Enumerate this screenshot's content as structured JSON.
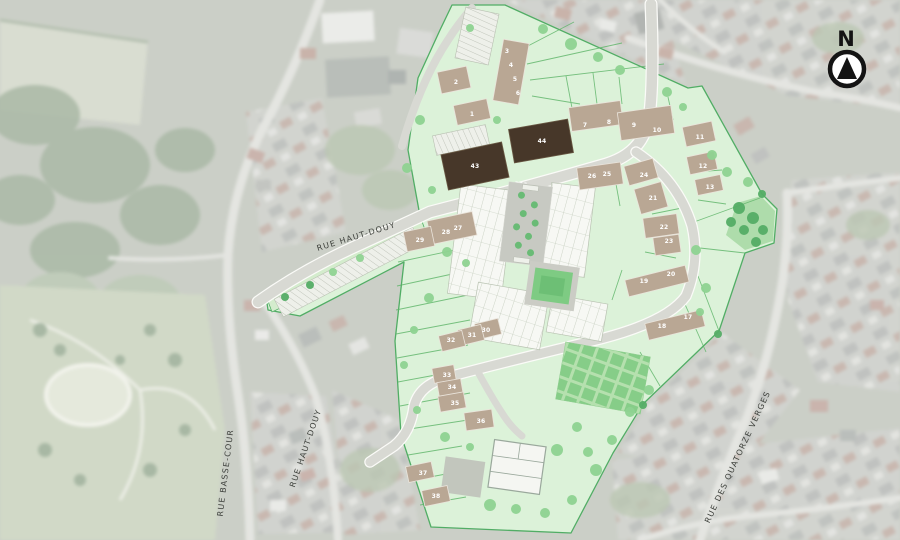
{
  "compass": {
    "label": "N"
  },
  "streets": [
    {
      "id": "rue-haut-douy-upper",
      "label": "RUE HAUT-DOUY",
      "x": 357,
      "y": 239,
      "angle": -17
    },
    {
      "id": "rue-basse-cour",
      "label": "RUE BASSE-COUR",
      "x": 228,
      "y": 473,
      "angle": -83
    },
    {
      "id": "rue-haut-douy-lower",
      "label": "RUE HAUT-DOUY",
      "x": 308,
      "y": 449,
      "angle": -71
    },
    {
      "id": "rue-des-quatorze-verges",
      "label": "RUE DES QUATORZE VERGES",
      "x": 740,
      "y": 458,
      "angle": -65
    }
  ],
  "lots": [
    {
      "n": "1",
      "x": 472,
      "y": 116
    },
    {
      "n": "2",
      "x": 456,
      "y": 84
    },
    {
      "n": "3",
      "x": 507,
      "y": 53
    },
    {
      "n": "4",
      "x": 511,
      "y": 67
    },
    {
      "n": "5",
      "x": 515,
      "y": 81
    },
    {
      "n": "6",
      "x": 518,
      "y": 95
    },
    {
      "n": "7",
      "x": 585,
      "y": 127
    },
    {
      "n": "8",
      "x": 609,
      "y": 124
    },
    {
      "n": "9",
      "x": 634,
      "y": 127
    },
    {
      "n": "10",
      "x": 657,
      "y": 132
    },
    {
      "n": "11",
      "x": 700,
      "y": 139
    },
    {
      "n": "12",
      "x": 703,
      "y": 168
    },
    {
      "n": "13",
      "x": 710,
      "y": 189
    },
    {
      "n": "17",
      "x": 688,
      "y": 319
    },
    {
      "n": "18",
      "x": 662,
      "y": 328
    },
    {
      "n": "19",
      "x": 644,
      "y": 283
    },
    {
      "n": "20",
      "x": 671,
      "y": 276
    },
    {
      "n": "21",
      "x": 653,
      "y": 200
    },
    {
      "n": "22",
      "x": 664,
      "y": 229
    },
    {
      "n": "23",
      "x": 669,
      "y": 243
    },
    {
      "n": "24",
      "x": 644,
      "y": 177
    },
    {
      "n": "25",
      "x": 607,
      "y": 176
    },
    {
      "n": "26",
      "x": 592,
      "y": 178
    },
    {
      "n": "27",
      "x": 458,
      "y": 230
    },
    {
      "n": "28",
      "x": 446,
      "y": 234
    },
    {
      "n": "29",
      "x": 420,
      "y": 242
    },
    {
      "n": "30",
      "x": 486,
      "y": 332
    },
    {
      "n": "31",
      "x": 472,
      "y": 337
    },
    {
      "n": "32",
      "x": 451,
      "y": 342
    },
    {
      "n": "33",
      "x": 447,
      "y": 377
    },
    {
      "n": "34",
      "x": 452,
      "y": 389
    },
    {
      "n": "35",
      "x": 455,
      "y": 405
    },
    {
      "n": "36",
      "x": 481,
      "y": 423
    },
    {
      "n": "37",
      "x": 423,
      "y": 475
    },
    {
      "n": "38",
      "x": 436,
      "y": 498
    },
    {
      "n": "43",
      "x": 475,
      "y": 168
    },
    {
      "n": "44",
      "x": 542,
      "y": 143
    }
  ],
  "colors": {
    "site_fill": "#dcf2d9",
    "site_border": "#51ad65",
    "building": "#b9a794",
    "building_dark": "#473729",
    "road": "#d8d9d3",
    "plaza": "#c7c9c2",
    "park_green": "#7ecb83",
    "tree_light": "#8fd392",
    "tree_dark": "#55ad66",
    "street_text": "#3e413c",
    "lot_text": "#ffffff"
  }
}
